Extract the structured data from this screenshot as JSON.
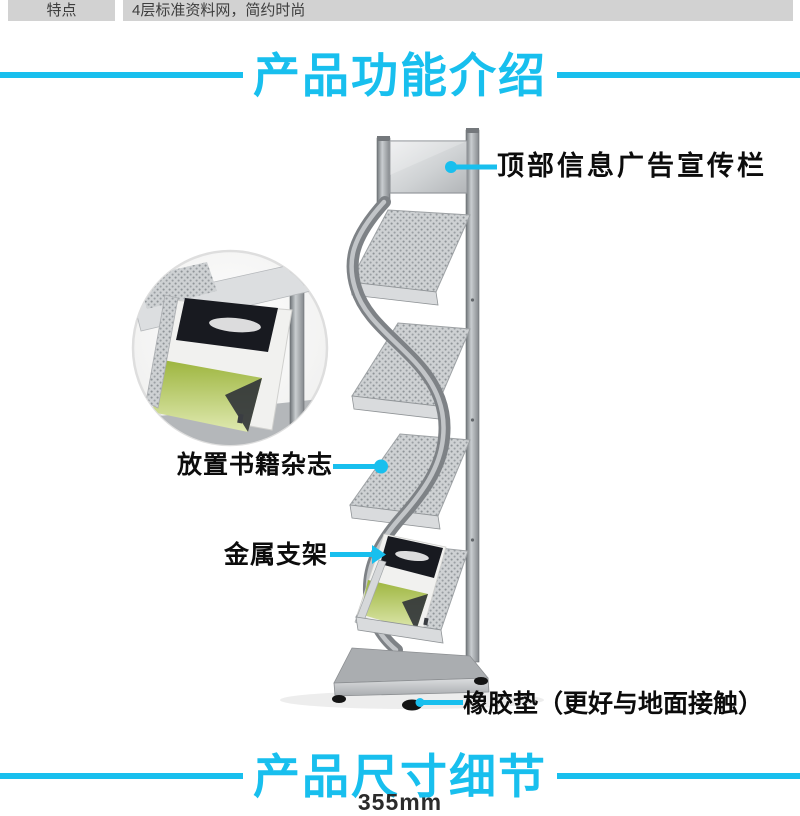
{
  "spec_bar": {
    "label": "特点",
    "value": "4层标准资料网，简约时尚"
  },
  "sections": {
    "features_title": "产品功能介绍",
    "dimensions_title": "产品尺寸细节"
  },
  "annotations": {
    "top_board": "顶部信息广告宣传栏",
    "shelf": "放置书籍杂志",
    "frame": "金属支架",
    "foot": "橡胶垫（更好与地面接触）"
  },
  "dimension_partial": "355mm",
  "colors": {
    "accent_cyan": "#18bfee",
    "spec_bar_bg": "#d2d2d2",
    "label_text": "#0c0c0c",
    "stand_silver": "#b3b7ba",
    "magazine_green": "#a9bf4f",
    "rubber_foot": "#141414"
  },
  "icons": {
    "callout_dot": "filled-circle",
    "callout_arrow": "triangle-right"
  }
}
